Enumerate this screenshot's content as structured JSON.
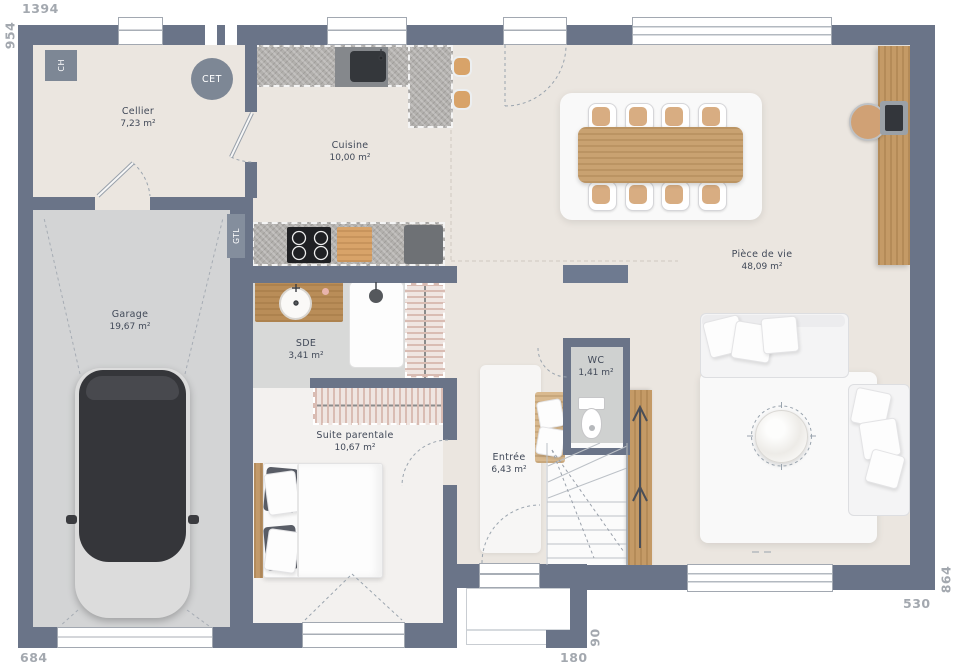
{
  "title": "Plan de maison - rez-de-chaussée",
  "dims": {
    "top": "1394",
    "left": "954",
    "bottom_left": "684",
    "porch_width": "180",
    "porch_depth": "90",
    "bottom_right": "530",
    "right": "864"
  },
  "rooms": {
    "cellier": {
      "name": "Cellier",
      "area": "7,23 m²"
    },
    "cuisine": {
      "name": "Cuisine",
      "area": "10,00 m²"
    },
    "garage": {
      "name": "Garage",
      "area": "19,67 m²"
    },
    "sde": {
      "name": "SDE",
      "area": "3,41 m²"
    },
    "suite": {
      "name": "Suite parentale",
      "area": "10,67 m²"
    },
    "entree": {
      "name": "Entrée",
      "area": "6,43 m²"
    },
    "wc": {
      "name": "WC",
      "area": "1,41 m²"
    },
    "piece_de_vie": {
      "name": "Pièce de vie",
      "area": "48,09 m²"
    }
  },
  "tags": {
    "ch": "CH",
    "cet": "CET",
    "gtl": "GTL"
  },
  "colors": {
    "wall": "#6a7488",
    "floor_main": "#ebe6e0",
    "floor_garage": "#d3d4d5",
    "floor_wet": "#d8d9d8",
    "floor_bedroom": "#f3f1ef",
    "wood": "#c49a66",
    "dim_text": "#a3a8af"
  }
}
